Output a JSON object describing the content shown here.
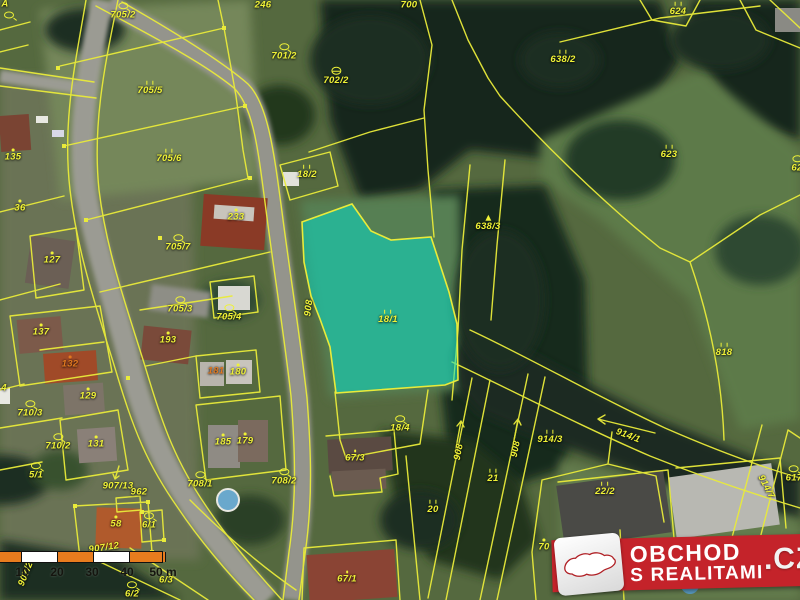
{
  "map": {
    "type": "cadastral-satellite-map",
    "highlight_parcel": "18/1",
    "colors": {
      "boundary_yellow": "#e9eb3a",
      "label_yellow": "#eff237",
      "label_orange": "#e2791f",
      "highlight_teal": "#00e4d0",
      "logo_red": "#c4232a",
      "scale_orange": "#e87c1e"
    },
    "parcels": [
      {
        "id": "A",
        "x": 5,
        "y": 4
      },
      {
        "id": "",
        "x": 9,
        "y": 15,
        "icon": "circle"
      },
      {
        "id": "705/2",
        "x": 123,
        "y": 11,
        "icon": "circle"
      },
      {
        "id": "246",
        "x": 263,
        "y": 5
      },
      {
        "id": "700",
        "x": 409,
        "y": 5
      },
      {
        "id": "624",
        "x": 678,
        "y": 9,
        "icon": "bars"
      },
      {
        "id": "705/5",
        "x": 150,
        "y": 88,
        "icon": "bars"
      },
      {
        "id": "701/2",
        "x": 284,
        "y": 52,
        "icon": "circle"
      },
      {
        "id": "702/2",
        "x": 336,
        "y": 76,
        "icon": "theta"
      },
      {
        "id": "638/2",
        "x": 563,
        "y": 57,
        "icon": "bars"
      },
      {
        "id": "705/6",
        "x": 169,
        "y": 156,
        "icon": "bars"
      },
      {
        "id": "623",
        "x": 669,
        "y": 152,
        "icon": "bars"
      },
      {
        "id": "62",
        "x": 797,
        "y": 164,
        "icon": "circle"
      },
      {
        "id": "135",
        "x": 13,
        "y": 155,
        "icon": "dot"
      },
      {
        "id": "36",
        "x": 20,
        "y": 206,
        "icon": "dot"
      },
      {
        "id": "18/2",
        "x": 307,
        "y": 172,
        "icon": "bars"
      },
      {
        "id": "233",
        "x": 236,
        "y": 215,
        "icon": "dot"
      },
      {
        "id": "705/7",
        "x": 178,
        "y": 243,
        "icon": "circle"
      },
      {
        "id": "638/3",
        "x": 488,
        "y": 223,
        "icon": "tree"
      },
      {
        "id": "127",
        "x": 52,
        "y": 258,
        "icon": "dot"
      },
      {
        "id": "908",
        "x": 309,
        "y": 308,
        "rot": -83
      },
      {
        "id": "18/1",
        "x": 388,
        "y": 317,
        "icon": "bars"
      },
      {
        "id": "705/3",
        "x": 180,
        "y": 305,
        "icon": "circle"
      },
      {
        "id": "705/4",
        "x": 229,
        "y": 313,
        "icon": "circle"
      },
      {
        "id": "137",
        "x": 41,
        "y": 330,
        "icon": "dot"
      },
      {
        "id": "193",
        "x": 168,
        "y": 338,
        "icon": "dot"
      },
      {
        "id": "818",
        "x": 724,
        "y": 350,
        "icon": "bars"
      },
      {
        "id": "132",
        "x": 70,
        "y": 362,
        "icon": "dot",
        "color": "orange"
      },
      {
        "id": "181",
        "x": 216,
        "y": 371,
        "color": "orange"
      },
      {
        "id": "180",
        "x": 238,
        "y": 370,
        "icon": "dot"
      },
      {
        "id": "4",
        "x": 4,
        "y": 388
      },
      {
        "id": "129",
        "x": 88,
        "y": 394,
        "icon": "dot"
      },
      {
        "id": "710/3",
        "x": 30,
        "y": 409,
        "icon": "circle"
      },
      {
        "id": "18/4",
        "x": 400,
        "y": 424,
        "icon": "circle"
      },
      {
        "id": "914/1",
        "x": 628,
        "y": 436,
        "rot": 21
      },
      {
        "id": "710/2",
        "x": 58,
        "y": 442,
        "icon": "circle"
      },
      {
        "id": "131",
        "x": 96,
        "y": 442,
        "icon": "dot"
      },
      {
        "id": "185",
        "x": 223,
        "y": 440,
        "icon": "dot"
      },
      {
        "id": "179",
        "x": 245,
        "y": 439,
        "icon": "dot"
      },
      {
        "id": "914/3",
        "x": 550,
        "y": 437,
        "icon": "bars"
      },
      {
        "id": "908",
        "x": 459,
        "y": 452,
        "rot": -79
      },
      {
        "id": "908",
        "x": 516,
        "y": 449,
        "rot": -79
      },
      {
        "id": "67/3",
        "x": 355,
        "y": 456,
        "icon": "dot"
      },
      {
        "id": "5/1",
        "x": 36,
        "y": 471,
        "icon": "circle"
      },
      {
        "id": "21",
        "x": 493,
        "y": 476,
        "icon": "bars"
      },
      {
        "id": "617",
        "x": 794,
        "y": 474,
        "icon": "circle"
      },
      {
        "id": "708/1",
        "x": 200,
        "y": 480,
        "icon": "circle"
      },
      {
        "id": "708/2",
        "x": 284,
        "y": 477,
        "icon": "circle"
      },
      {
        "id": "907/13",
        "x": 118,
        "y": 486
      },
      {
        "id": "962",
        "x": 139,
        "y": 492
      },
      {
        "id": "914/7",
        "x": 766,
        "y": 487,
        "rot": 62
      },
      {
        "id": "22/2",
        "x": 605,
        "y": 489,
        "icon": "bars"
      },
      {
        "id": "20",
        "x": 433,
        "y": 507,
        "icon": "bars"
      },
      {
        "id": "58",
        "x": 116,
        "y": 522,
        "icon": "dot"
      },
      {
        "id": "6/1",
        "x": 149,
        "y": 521,
        "icon": "circle"
      },
      {
        "id": "907/12",
        "x": 104,
        "y": 548,
        "rot": -8
      },
      {
        "id": "70",
        "x": 544,
        "y": 545,
        "icon": "dot"
      },
      {
        "id": "907/2",
        "x": 26,
        "y": 574,
        "rot": -68
      },
      {
        "id": "67/1",
        "x": 347,
        "y": 577,
        "icon": "dot"
      },
      {
        "id": "6/3",
        "x": 166,
        "y": 580
      },
      {
        "id": "6/2",
        "x": 132,
        "y": 590,
        "icon": "circle"
      }
    ]
  },
  "scale_bar": {
    "labels": [
      "10",
      "20",
      "30",
      "40",
      "50 m"
    ],
    "positions": [
      22,
      57,
      92,
      127,
      163
    ]
  },
  "logo": {
    "line1": "OBCHOD",
    "line2": "S REALITAMI",
    "tld": ".CZ",
    "emblem": "czech-republic-map"
  }
}
